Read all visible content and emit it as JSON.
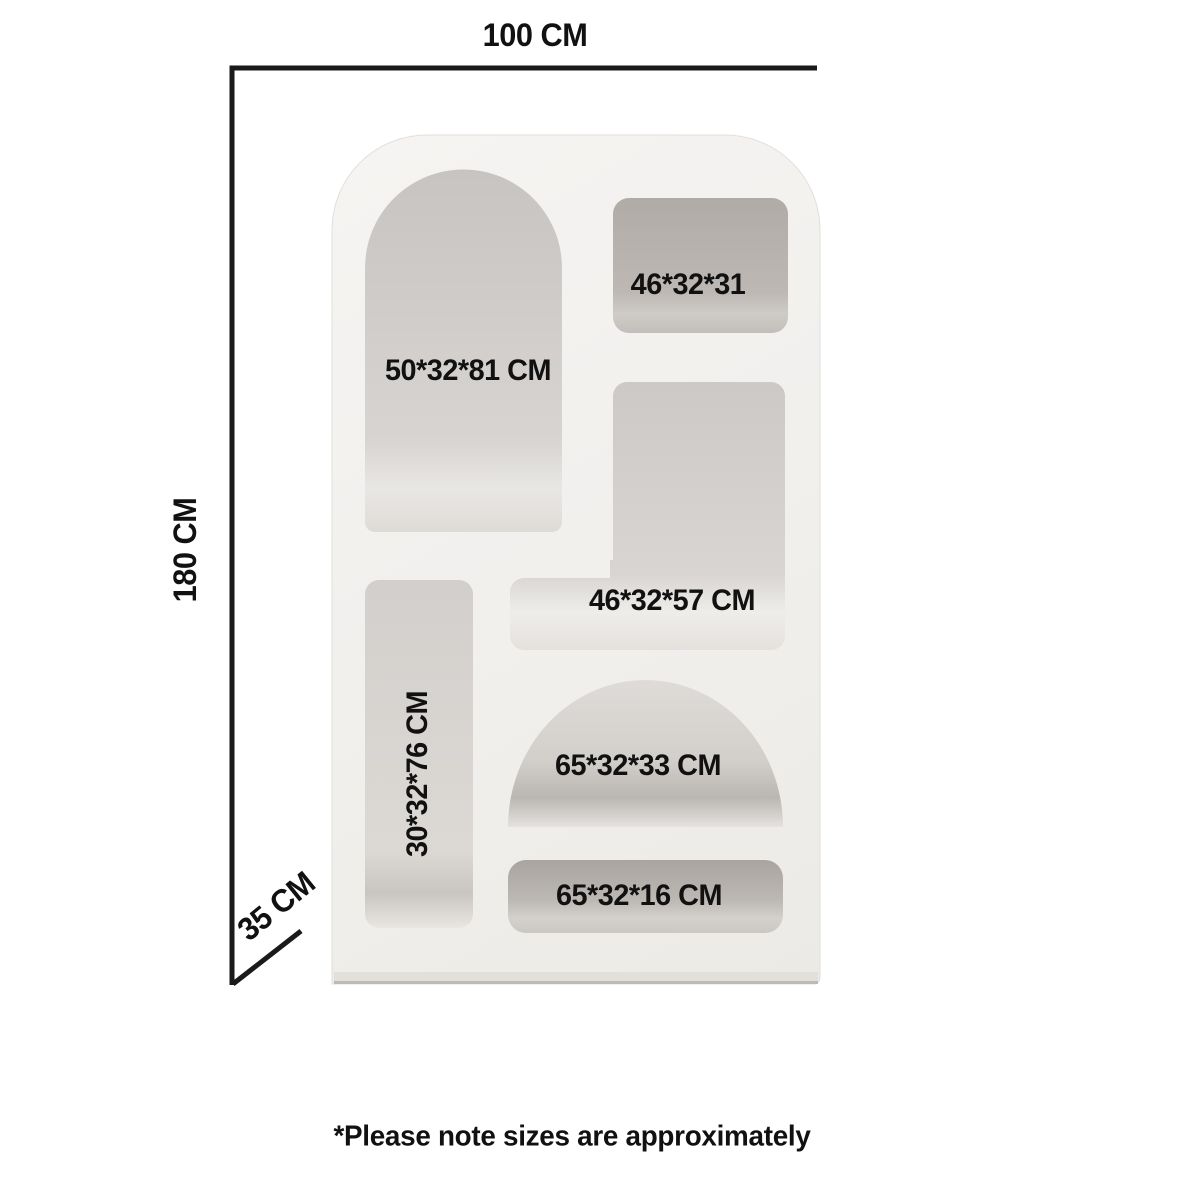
{
  "dimensions": {
    "width": "100 CM",
    "height": "180 CM",
    "depth": "35 CM"
  },
  "compartments": [
    {
      "id": "tall-arch-niche",
      "label": "50*32*81 CM"
    },
    {
      "id": "top-right-niche",
      "label": "46*32*31"
    },
    {
      "id": "middle-right-niche",
      "label": "46*32*57 CM"
    },
    {
      "id": "left-column-niche",
      "label": "30*32*76 CM"
    },
    {
      "id": "dome-niche",
      "label": "65*32*33 CM"
    },
    {
      "id": "bottom-slot-niche",
      "label": "65*32*16 CM"
    }
  ],
  "note": "*Please note sizes are approximately",
  "colors": {
    "background": "#ffffff",
    "line": "#1a1a1a",
    "text": "#111111",
    "body": "#f2f0ed",
    "niche_dark": "#b3aeaa",
    "niche_light": "#e9e7e4"
  }
}
